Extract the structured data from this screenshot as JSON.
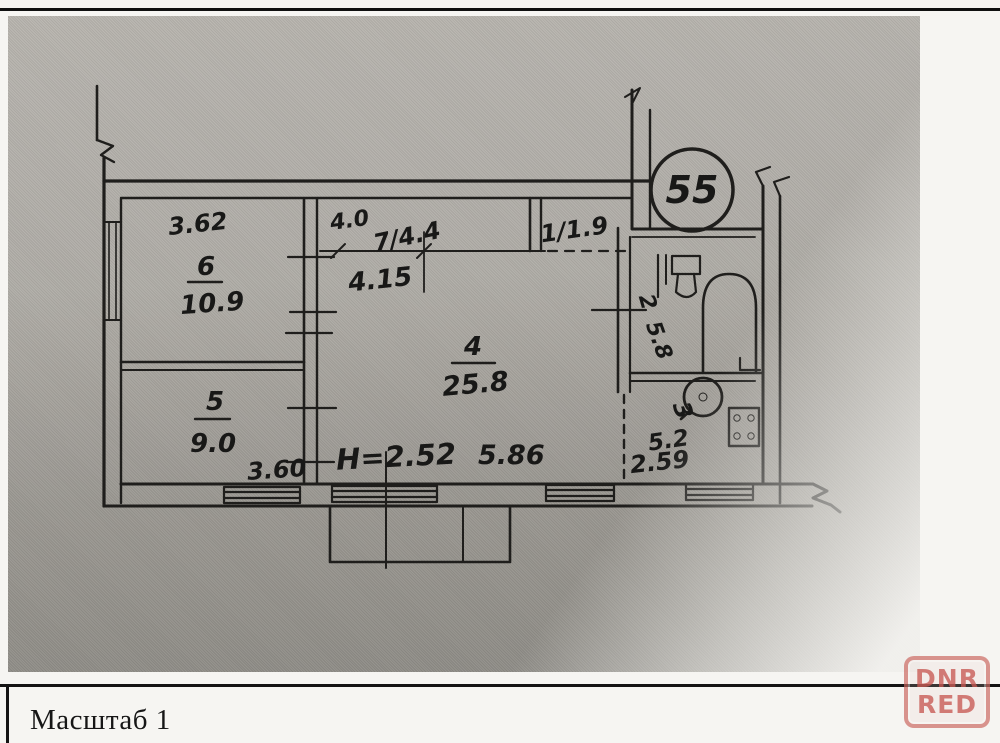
{
  "document": {
    "scale_label": "Масштаб 1"
  },
  "watermark": {
    "line1": "DNR",
    "line2": "RED",
    "color": "#c6584e"
  },
  "plan": {
    "apartment_number": "55",
    "rooms": {
      "room6": {
        "number": "6",
        "area": "10.9",
        "width_dim": "3.62"
      },
      "room5": {
        "number": "5",
        "area": "9.0",
        "width_dim": "3.60"
      },
      "room7": {
        "label": "7/4.4",
        "top_dim": "4.0",
        "width_dim": "4.15"
      },
      "room1": {
        "label": "1/1.9"
      },
      "room4": {
        "number": "4",
        "area": "25.8",
        "width_dim": "5.86",
        "height_note": "H=2.52"
      },
      "room2": {
        "number": "2",
        "area": "5.8"
      },
      "room3": {
        "number": "3",
        "area": "5.2",
        "width_dim": "2.59"
      }
    }
  }
}
